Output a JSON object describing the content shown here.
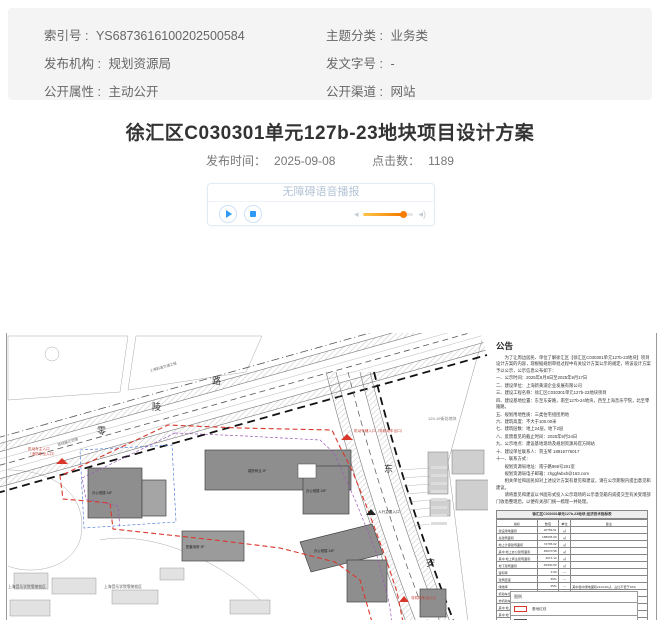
{
  "meta_panel": {
    "left": [
      {
        "label": "索引号 :",
        "value": "YS6873616100202500584"
      },
      {
        "label": "发布机构 :",
        "value": "规划资源局"
      },
      {
        "label": "公开属性 :",
        "value": "主动公开"
      }
    ],
    "right": [
      {
        "label": "主题分类 :",
        "value": "业务类"
      },
      {
        "label": "发文字号 :",
        "value": "-"
      },
      {
        "label": "公开渠道 :",
        "value": "网站"
      }
    ]
  },
  "article": {
    "title": "徐汇区C030301单元127b-23地块项目设计方案",
    "publish_label": "发布时间：",
    "publish_date": "2025-09-08",
    "hits_label": "点击数：",
    "hits": "1189"
  },
  "player": {
    "title": "无障碍语音播报"
  },
  "colors": {
    "accent_blue": "#2e9af5",
    "slider_orange": "#f77c00",
    "boundary_red": "#d9372b"
  },
  "plan": {
    "map": {
      "roads": {
        "linglu": [
          "零",
          "陵",
          "路"
        ],
        "dongan": [
          "东",
          "安"
        ]
      },
      "labels": {
        "metro": "上海轨道交通工程",
        "pipeline": "管线搬迁范围",
        "block": "129-19街坊地块",
        "entrance_main_1": "机动车主入口",
        "entrance_main_2": "（消防车出入口）",
        "entrance_aux": "机动车辅入口（非机动车出口）",
        "entrance_ped": "人行主要入口",
        "entrance_bike": "非机动车出入口",
        "school_left": "上海音乐学院零陵校区",
        "school_right": "上海音乐学院零陵校区",
        "bldg1": "裙房商业 2F",
        "bldg2": "办公塔楼 24F",
        "bldg3": "办公塔楼 24F",
        "bldg4": "配套用房 3F",
        "bldg5": "办公塔楼 24F"
      }
    },
    "notice": {
      "title": "公告",
      "lines": [
        "　　为了让周边居民、单位了解徐汇区【徐汇区C030301单元127b-23地块】项目设计方案的内容，现根据规划审批过程中有关设计方案公示的规定，将该设计方案予以公示，公示信息公布如下：",
        "一、公示时间：2025年9月8日至2025年9月17日",
        "二、建设单位：上海新黄浦企业发展有限公司",
        "三、建设工程名称：徐汇区C030301单元127b-23地块项目",
        "四、建设基地位置：东至东安路，南至127b-24地块，西至上海音乐学院，北至零陵路。",
        "五、规划用地性质：三类住宅组团用地",
        "六、建筑高度：不大于100.00米",
        "七、建筑层数：地上24层，地下2层",
        "八、反馈意见的截止时间：2025年9月24日",
        "九、公示地点：建设基地现场及规划资源局官方网站",
        "十、建设单位联系人：贺玉琴 18916776017",
        "十一、联系方式：",
        "　　规划资源局地址：南宁路969号201室",
        "　　规划资源局电子邮箱：zhggfwbxh@163.com",
        "　　相关单位和居民如对上述设计方案有意见和建议，请在公示期限内提出意见和建议。",
        "　　请将意见和建议以书面形式投入公示现场的公示意见箱内或提交至有关受理部门收悉整理后，以便有关部门统一梳理一并处理。"
      ],
      "table": {
        "title": "徐汇区C030301单元127b-23地块 经济技术指标表",
        "header": [
          "指标",
          "数值",
          "单位",
          "备注"
        ],
        "rows": [
          [
            "建设用地面积",
            "20759.61",
            "㎡",
            ""
          ],
          [
            "总建筑面积",
            "188935.00",
            "㎡",
            ""
          ],
          [
            "地上计容建筑面积",
            "74795.02",
            "㎡",
            ""
          ],
          [
            "其中 地上办公建筑面积",
            "66070.58",
            "㎡",
            ""
          ],
          [
            "其中 地上商业建筑面积",
            "4071.14",
            "㎡",
            ""
          ],
          [
            "地下建筑面积",
            "81930.00",
            "㎡",
            ""
          ],
          [
            "容积率",
            "3.60",
            "—",
            ""
          ],
          [
            "建筑密度",
            "30%",
            "—",
            ""
          ],
          [
            "绿地率",
            "25%",
            "—",
            "其中集中绿地面积2113.00㎡，占比不低于10%"
          ],
          [
            "机动车位",
            "608",
            "辆",
            "按规范配建"
          ],
          [
            "非机动车停车位",
            "606",
            "辆",
            ""
          ],
          [
            "其中 地上",
            "8",
            "辆",
            ""
          ],
          [
            "其中 地下",
            "598",
            "辆",
            ""
          ],
          [
            "装卸车停车位",
            "27",
            "辆",
            ""
          ],
          [
            "其中 地上",
            "5",
            "辆",
            ""
          ],
          [
            "其中 地下",
            "22",
            "辆",
            ""
          ]
        ]
      },
      "legend": {
        "header": "图例",
        "rows": [
          {
            "label": "基地红线"
          },
          {
            "label": "拟建建筑"
          }
        ]
      }
    }
  }
}
